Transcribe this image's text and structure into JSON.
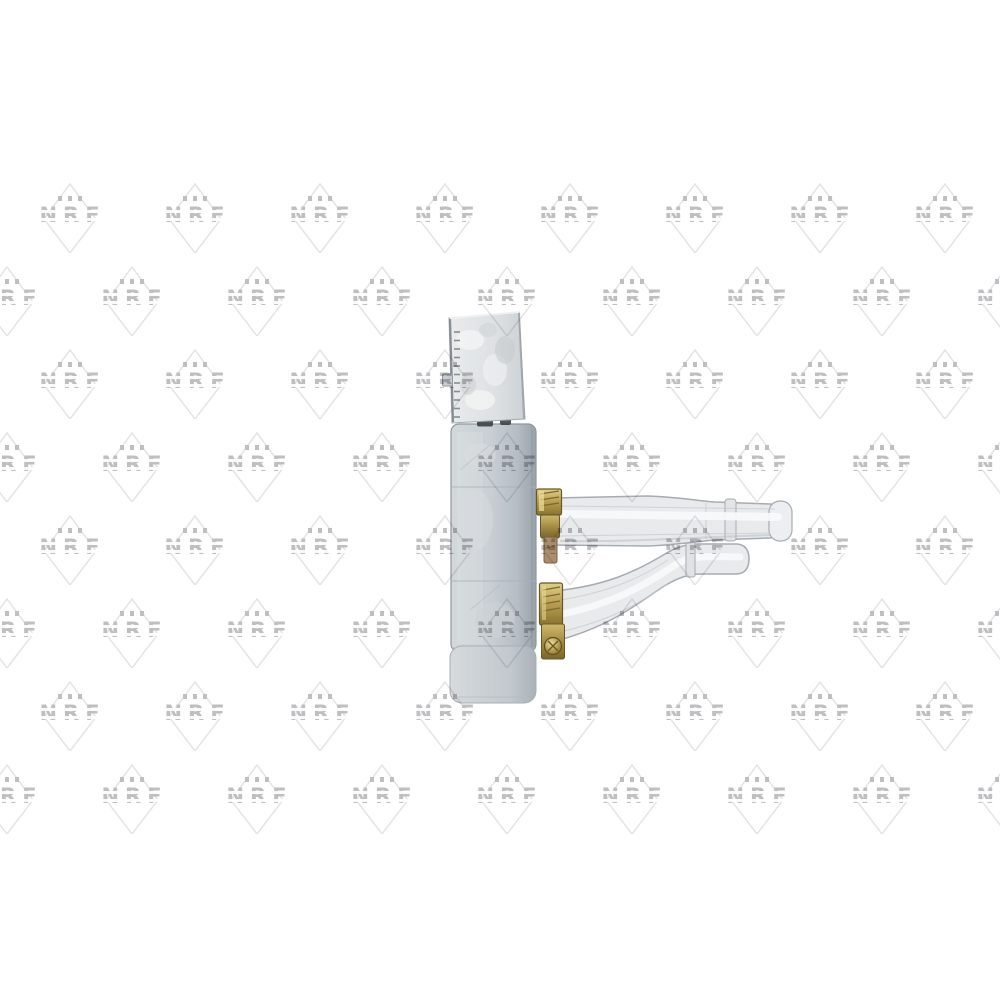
{
  "window": {
    "width": 1000,
    "height": 1000,
    "background": "#ffffff"
  },
  "photo": {
    "type": "product-photo",
    "subject": "Automotive heater core / heat exchanger, side profile view",
    "details": "Light grey core body with white plastic top tank, two translucent coolant hoses exiting to the right, each secured with a brass worm-drive hose clamp"
  },
  "watermark": {
    "text": "NRF",
    "dots": 3,
    "text_color": "#bfbfc2",
    "diamond_color": "#e4e4e6",
    "grid": {
      "rows": 8,
      "row_start_y": 215,
      "row_spacing_y": 83,
      "col_spacing_x": 125,
      "even_row_first_x": 70,
      "even_row_count": 8,
      "odd_row_first_x": 7,
      "odd_row_count": 9
    }
  },
  "colors": {
    "background": "#ffffff",
    "wm_text": "#bfbfc2",
    "wm_diamond": "#e4e4e6",
    "tank_light": "#e9ebec",
    "tank_mid": "#dde1e3",
    "tank_dark": "#ccd1d5",
    "tank_edge": "#7d858c",
    "body_light": "#d3d8db",
    "body_mid": "#c9cfd4",
    "body_dark": "#a2aab2",
    "body_edge": "#8f979f",
    "lower_light": "#d6dadd",
    "lower_dark": "#aab1b8",
    "tube_fill": "#e8eaec",
    "tube_edge": "#a6acb2",
    "tube_highlight": "#f8fafb",
    "clamp_gold_light": "#e0cf87",
    "clamp_gold": "#b79d50",
    "clamp_gold_dark": "#8a7331",
    "clamp_outline": "#6a5824",
    "clamp_rust": "#ab8d6d",
    "slot_dark": "#3c4146"
  }
}
